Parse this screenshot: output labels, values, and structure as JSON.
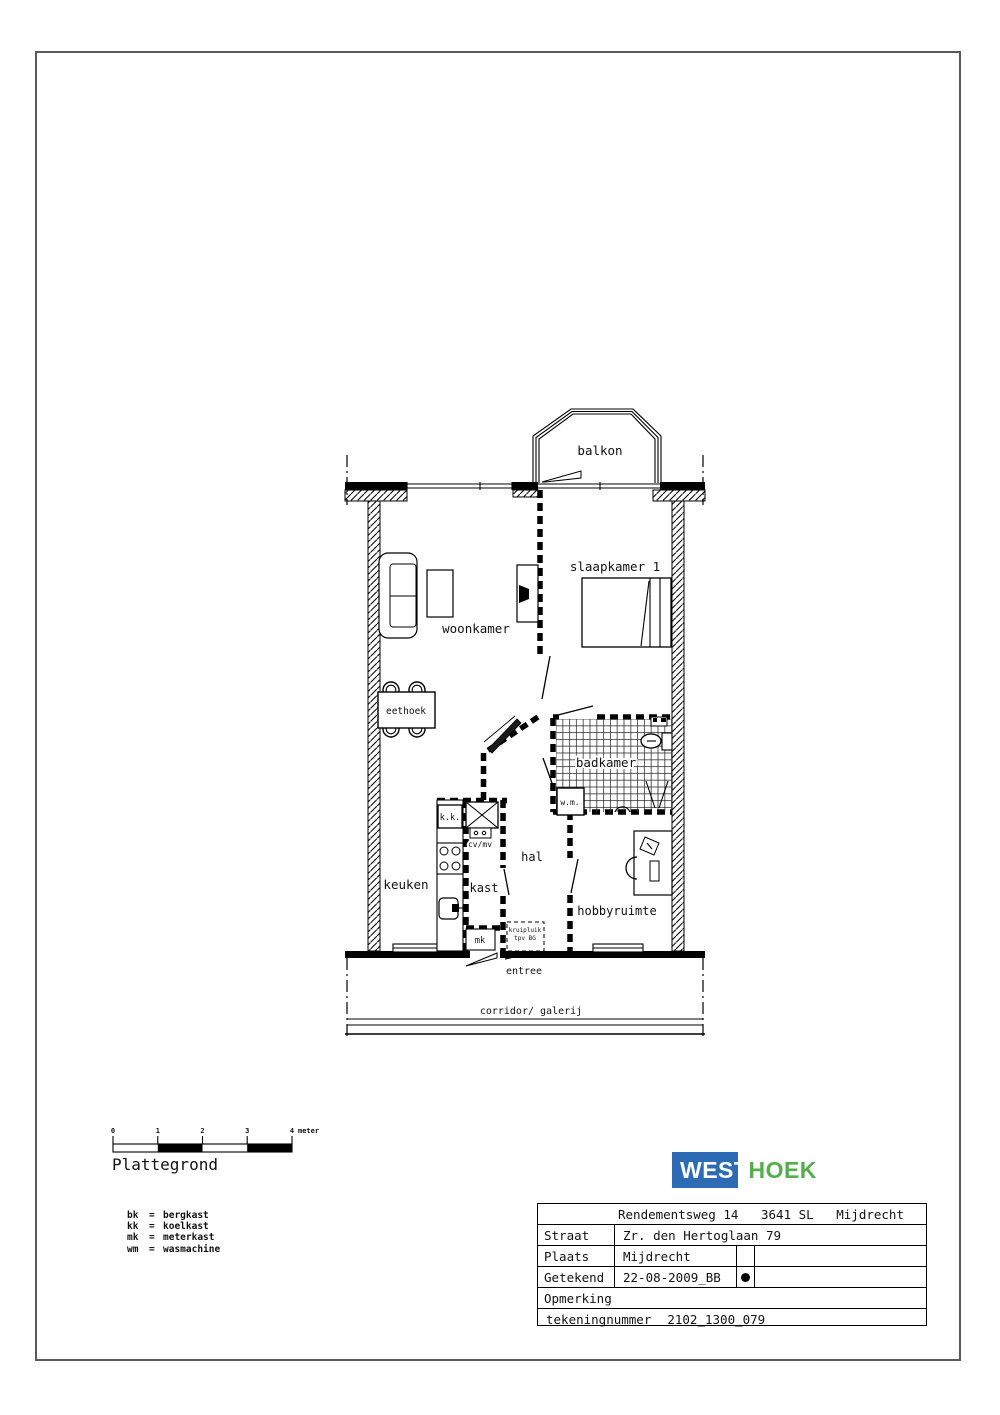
{
  "drawing_title": "Plattegrond",
  "rooms": {
    "balkon": "balkon",
    "slaapkamer1": "slaapkamer 1",
    "woonkamer": "woonkamer",
    "eethoek": "eethoek",
    "badkamer": "badkamer",
    "keuken": "keuken",
    "kast": "kast",
    "hal": "hal",
    "hobbyruimte": "hobbyruimte",
    "entree": "entree",
    "corridor": "corridor/ galerij"
  },
  "fixtures": {
    "wm": "w.m.",
    "kk": "k.k.",
    "cvmv": "cv/mv",
    "mk": "mk",
    "kruipluik_line1": "kruipluik",
    "kruipluik_line2": "tpv BG"
  },
  "scalebar": {
    "ticks": [
      "0",
      "1",
      "2",
      "3",
      "4"
    ],
    "unit": "meter"
  },
  "legend": {
    "separator": "=",
    "items": [
      {
        "abbr": "bk",
        "name": "bergkast"
      },
      {
        "abbr": "kk",
        "name": "koelkast"
      },
      {
        "abbr": "mk",
        "name": "meterkast"
      },
      {
        "abbr": "wm",
        "name": "wasmachine"
      }
    ]
  },
  "logo": {
    "west": "WEST",
    "hoek": "HOEK",
    "blue": "#2d6cb4",
    "green": "#55ad4d"
  },
  "titleblock": {
    "address": "Rendementsweg 14   3641 SL   Mijdrecht",
    "straat_label": "Straat",
    "straat_value": "Zr. den Hertoglaan 79",
    "plaats_label": "Plaats",
    "plaats_value": "Mijdrecht",
    "getekend_label": "Getekend",
    "getekend_value": "22-08-2009_BB",
    "opmerking_label": "Opmerking",
    "tekeningnummer_label": "tekeningnummer",
    "tekeningnummer_value": "2102_1300_079"
  }
}
